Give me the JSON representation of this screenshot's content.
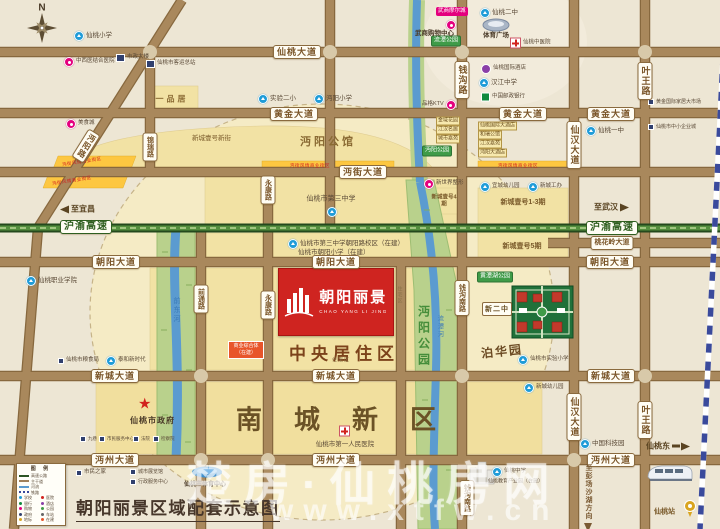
{
  "title": "朝阳丽景区域配套示意图",
  "compass_label": "N",
  "watermark": {
    "brand": "楚房·仙桃房网",
    "url": "www.xtfw.cn"
  },
  "project": {
    "logo_name": "朝阳丽景",
    "logo_en": "CHAO YANG LI JING"
  },
  "zones": {
    "central_residential": "中央居住区",
    "south_new_district": "南城新区",
    "mianyang_mansion": "沔阳公馆",
    "bohua_garden": "泊华园",
    "new_no2_middle": "新二中",
    "residential_area": "住宅区",
    "commercial_complex": "商业综合体（在建）"
  },
  "roads": {
    "xiantao_avenue": "仙桃大道",
    "huangjin_avenue": "黄金大道",
    "mianjie_avenue": "沔街大道",
    "taohualing_avenue": "桃花岭大道",
    "chaoyang_avenue": "朝阳大道",
    "xincheng_avenue": "新城大道",
    "mianzhou_avenue": "沔州大道",
    "qiangou_road": "钱沟路",
    "qiangou_south_road": "钱沟南路",
    "xianhan_avenue": "仙汉大道",
    "yewang_road": "叶王路",
    "jinrui_road": "锦瑞路",
    "qiantong_road": "前通路",
    "yongkang_road": "永康路",
    "mianyang_road": "沔阳路"
  },
  "highway": {
    "name": "沪渝高速",
    "west": "至宜昌",
    "east": "至武汉",
    "south_dir": "至彭场沙湖方向",
    "east_exit": "仙桃东"
  },
  "waters": {
    "qiandong_river": "前东河",
    "liutan_river": "流潭河"
  },
  "parks": {
    "mianyang_park": "沔阳公园",
    "liutan_park": "流潭公园",
    "huangtanhu_park": "黄潭湖公园"
  },
  "strips": {
    "food_street": "沔街风情商业街区"
  },
  "station": {
    "train_station": "仙桃站"
  },
  "pois": {
    "xiantao_primary": "仙桃小学",
    "zhongxiyi_hospital": "中西医结合医院",
    "municipal_building": "市政大楼",
    "bus_terminal": "仙桃市客运总站",
    "yipinju": "一品居",
    "food_city": "美食城",
    "shiyan_2nd": "实验二小",
    "mianyang_primary": "沔阳小学",
    "xincheng_yihao_street": "新城壹号新街",
    "wushang_mall": "武商摩尔城",
    "wushang_shopping": "武商购物中心",
    "xiantao_2nd_middle": "仙桃二中",
    "sports_plaza": "体育广场",
    "tcm_hospital": "仙桃中医院",
    "intl_hotel": "仙桃国际酒店",
    "hanjiang_middle": "汉江中学",
    "postal_bank": "中国邮政银行",
    "gold_home_market": "黄金国际家居大市场",
    "sme_city": "仙桃市中小企业城",
    "xiantao_1st_middle": "仙桃一中",
    "pinge_ktv": "品格KTV",
    "jinyu_garden": "金域花园",
    "jianghan_mingju": "江汉名居",
    "chengshi_jiayuan": "城市嘉苑",
    "intl_grand_hotel": "仙桃国际大酒店",
    "herui_mansion": "和瑞公馆",
    "jianghan_jiayuan": "江汉嘉苑",
    "mianyang_hotel": "沔阳大酒店",
    "third_middle": "仙桃市第三中学",
    "third_middle_branch": "仙桃市第三中学朝阳路校区（在建）",
    "chaoyang_primary": "仙桃市朝阳小学（在建）",
    "xinshijie_plastic": "新世界整形",
    "xincheng_yihao_4": "新城壹号4期",
    "yicheng_kindergarten": "宜城幼儿园",
    "xincheng_gongban": "新城工办",
    "xincheng_yihao_13": "新城壹号1-3期",
    "xincheng_yihao_5": "新城壹号5期",
    "vocational_college": "仙桃职业学院",
    "grain_bureau": "仙桃市粮食局",
    "taihe_new_era": "泰和新时代",
    "city_gov": "仙桃市政府",
    "jiuxiang": "九巷",
    "citizen_service": "市民服务中心",
    "court": "法院",
    "procuratorate": "检察院",
    "citizen_home": "市民之家",
    "exhibition_hall": "城市展览馆",
    "admin_center": "行政服务中心",
    "sports_center": "仙桃市体育中心",
    "first_hospital": "仙桃市第一人民医院",
    "tech_park": "中国科技园",
    "xiantao_middle": "仙桃中学",
    "edu_park": "仙桃教育产业园（在建）",
    "shiyan_primary": "仙桃市实验小学",
    "xincheng_kindergarten": "新城幼儿园"
  },
  "legend": {
    "title": "图 例",
    "line_items": [
      {
        "label": "高速公路",
        "color": "#2c5423"
      },
      {
        "label": "主干道",
        "color": "#a0805a"
      },
      {
        "label": "河流",
        "color": "#5b9bd0"
      },
      {
        "label": "铁路",
        "color": "#3a4a9c"
      }
    ],
    "items": [
      {
        "label": "学校",
        "color": "#1f9cd8"
      },
      {
        "label": "医院",
        "color": "#d2231e"
      },
      {
        "label": "银行",
        "color": "#0f8a3e"
      },
      {
        "label": "酒店",
        "color": "#8a3fa8"
      },
      {
        "label": "购物",
        "color": "#e4007e"
      },
      {
        "label": "公园",
        "color": "#3f9b48"
      },
      {
        "label": "政府",
        "color": "#31406e"
      },
      {
        "label": "车站",
        "color": "#666666"
      },
      {
        "label": "地标",
        "color": "#d9a520"
      },
      {
        "label": "在建",
        "color": "#e8552a"
      }
    ]
  }
}
